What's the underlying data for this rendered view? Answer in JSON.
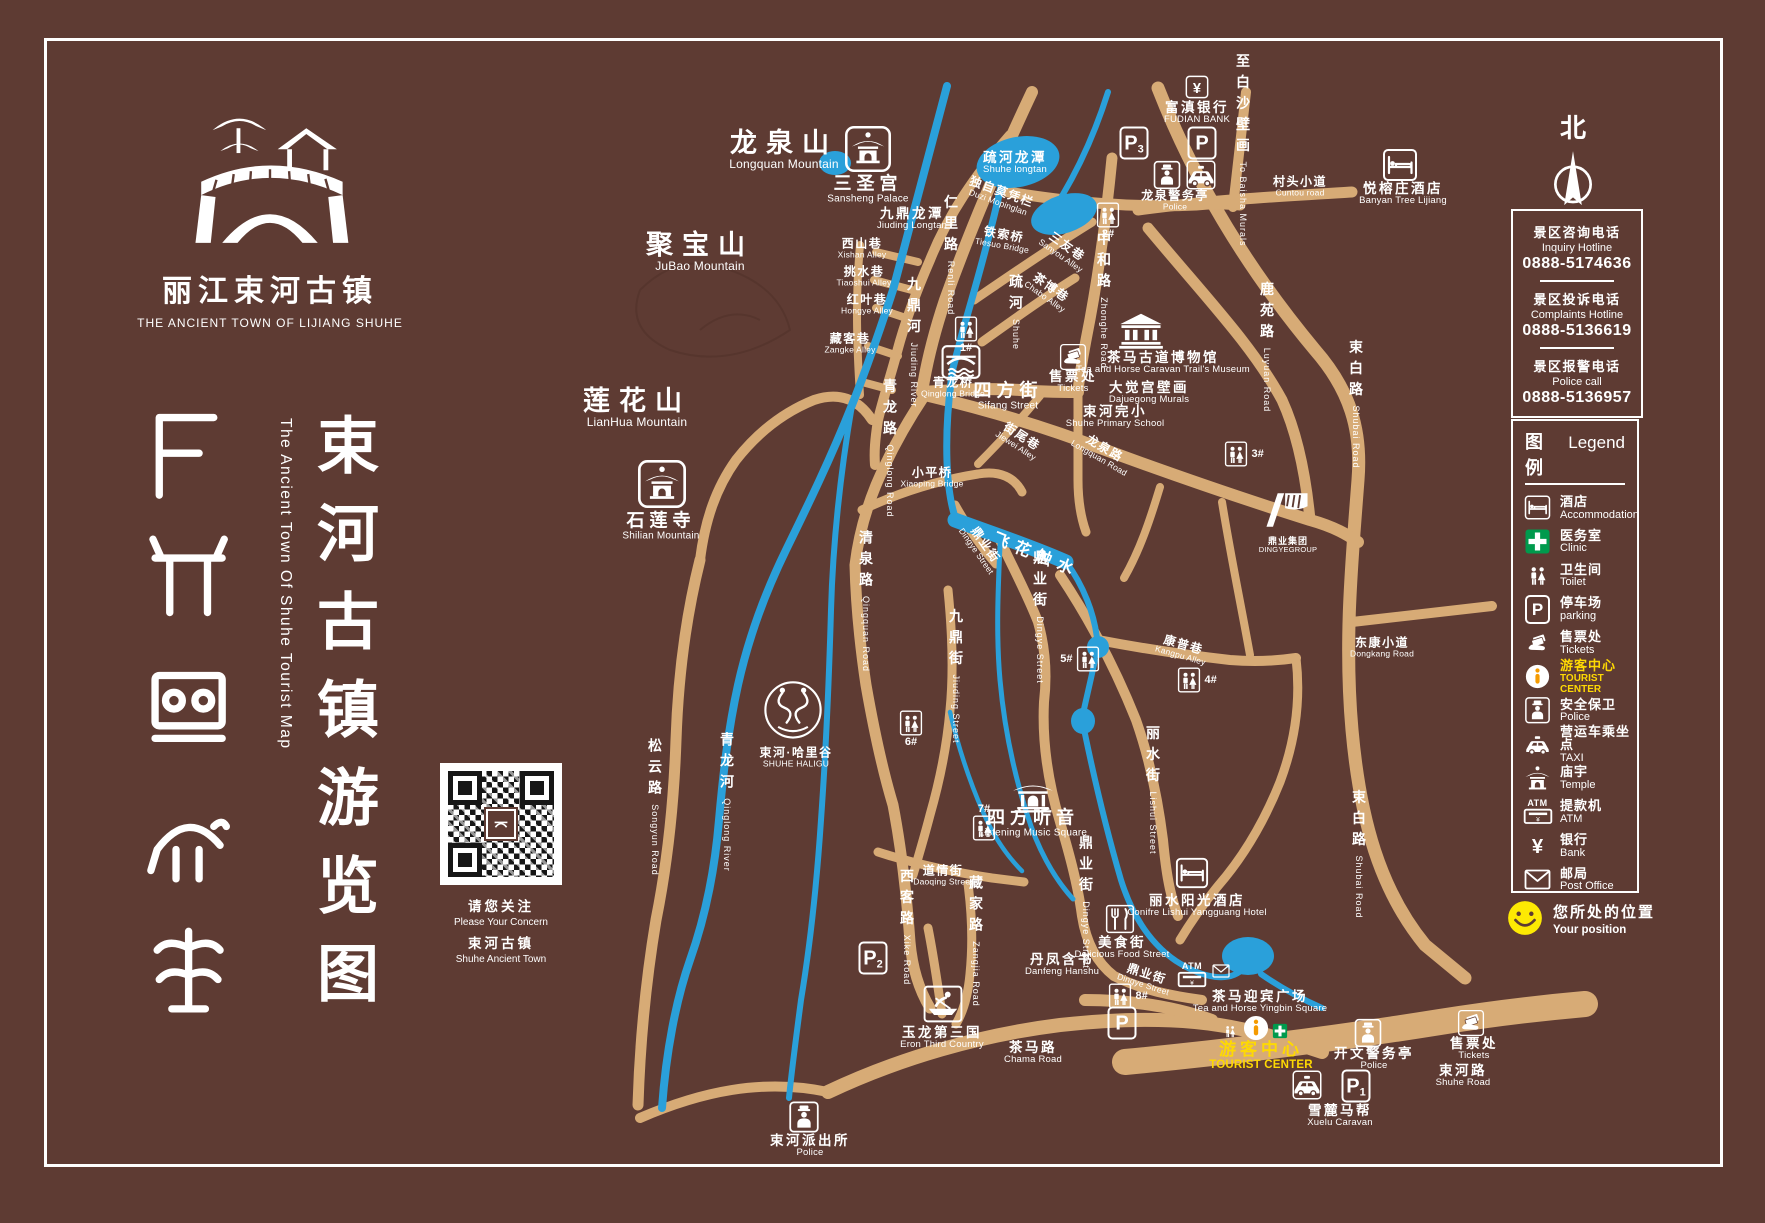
{
  "colors": {
    "background": "#5e3b33",
    "road": "#d7ab76",
    "water": "#2aa0da",
    "accent_yellow": "#fed903",
    "accent_orange": "#f59b00",
    "accent_green": "#009a4d"
  },
  "logo": {
    "zh": "丽江束河古镇",
    "en": "THE ANCIENT TOWN OF LIJIANG SHUHE"
  },
  "title": {
    "zh": "束河古镇游览图",
    "en": "The Ancient Town Of Shuhe Tourist Map"
  },
  "qr": {
    "l1": "请您关注",
    "l2": "Please Your Concern",
    "l3": "束河古镇",
    "l4": "Shuhe Ancient Town"
  },
  "north": {
    "label": "北"
  },
  "hotlines": [
    {
      "zh": "景区咨询电话",
      "en": "Inquiry Hotline",
      "num": "0888-5174636"
    },
    {
      "zh": "景区投诉电话",
      "en": "Complaints Hotline",
      "num": "0888-5136619"
    },
    {
      "zh": "景区报警电话",
      "en": "Police call",
      "num": "0888-5136957"
    }
  ],
  "legend": {
    "title_zh": "图例",
    "title_en": "Legend",
    "items": [
      {
        "icon": "bed",
        "zh": "酒店",
        "en": "Accommodation"
      },
      {
        "icon": "cross",
        "zh": "医务室",
        "en": "Clinic"
      },
      {
        "icon": "wc",
        "zh": "卫生间",
        "en": "Toilet"
      },
      {
        "icon": "p",
        "zh": "停车场",
        "en": "parking"
      },
      {
        "icon": "ticket",
        "zh": "售票处",
        "en": "Tickets"
      },
      {
        "icon": "info",
        "zh": "游客中心",
        "en": "TOURIST CENTER",
        "yellow": true
      },
      {
        "icon": "police",
        "zh": "安全保卫",
        "en": "Police"
      },
      {
        "icon": "taxi",
        "zh": "营运车乘坐点",
        "en": "TAXI"
      },
      {
        "icon": "temple",
        "zh": "庙宇",
        "en": "Temple"
      },
      {
        "icon": "atm",
        "zh": "提款机",
        "en": "ATM"
      },
      {
        "icon": "yen",
        "zh": "银行",
        "en": "Bank"
      },
      {
        "icon": "envelope",
        "zh": "邮局",
        "en": "Post Office"
      }
    ]
  },
  "position": {
    "zh": "您所处的位置",
    "en": "Your position"
  },
  "map": {
    "labels": [
      {
        "n": "label-longquan-mountain",
        "x": 784,
        "y": 150,
        "zh": "龙泉山",
        "en": "Longquan Mountain",
        "c": "mtn"
      },
      {
        "n": "label-jubao-mountain",
        "x": 700,
        "y": 252,
        "zh": "聚宝山",
        "en": "JuBao Mountain",
        "c": "mtn"
      },
      {
        "n": "label-lianhua-mountain",
        "x": 637,
        "y": 408,
        "zh": "莲花山",
        "en": "LianHua Mountain",
        "c": "mtn"
      },
      {
        "n": "label-sansheng-palace",
        "x": 868,
        "y": 189,
        "zh": "三圣宫",
        "en": "Sansheng Palace",
        "c": "plg"
      },
      {
        "n": "label-shilian-temple",
        "x": 661,
        "y": 526,
        "zh": "石莲寺",
        "en": "Shilian Mountain",
        "c": "plg"
      },
      {
        "n": "label-qinglong-bridge",
        "x": 953,
        "y": 388,
        "zh": "青龙桥",
        "en": "Qinglong Bridge",
        "c": "sm"
      },
      {
        "n": "label-sifang-street",
        "x": 1008,
        "y": 396,
        "zh": "四方街",
        "en": "Sifang Street",
        "c": "plg"
      },
      {
        "n": "label-tea-horse-museum",
        "x": 1163,
        "y": 363,
        "zh": "茶马古道博物馆",
        "en": "Tea and Horse Caravan Trail's Museum",
        "c": ""
      },
      {
        "n": "label-dajuegong-murals",
        "x": 1149,
        "y": 393,
        "zh": "大觉宫壁画",
        "en": "Dajuegong Murals",
        "c": ""
      },
      {
        "n": "label-shuhe-primary-school",
        "x": 1115,
        "y": 417,
        "zh": "束河完小",
        "en": "Shuhe Primary School",
        "c": ""
      },
      {
        "n": "label-shuhe-longtan",
        "x": 1015,
        "y": 163,
        "zh": "疏河龙潭",
        "en": "Shuhe longtan",
        "c": ""
      },
      {
        "n": "label-jiuding-longtan",
        "x": 912,
        "y": 219,
        "zh": "九鼎龙潭",
        "en": "Jiuding Longtan",
        "c": ""
      },
      {
        "n": "label-duzi-mopinglan",
        "x": 1000,
        "y": 197,
        "zh": "独自莫凭栏",
        "en": "Duzi Mopinglan",
        "c": "sm",
        "r": 20
      },
      {
        "n": "label-tiesuo-bridge",
        "x": 1003,
        "y": 240,
        "zh": "铁索桥",
        "en": "Tiesuo Bridge",
        "c": "sm",
        "r": 10
      },
      {
        "n": "label-xiaoping-bridge",
        "x": 932,
        "y": 478,
        "zh": "小平桥",
        "en": "Xiaoping Bridge",
        "c": "sm"
      },
      {
        "n": "label-listening-music-square",
        "x": 1033,
        "y": 823,
        "zh": "四方听音",
        "en": "Listening Music Square",
        "c": "plg"
      },
      {
        "n": "label-eron-third-country",
        "x": 942,
        "y": 1038,
        "zh": "玉龙第三国",
        "en": "Eron Third Country",
        "c": ""
      },
      {
        "n": "label-tea-horse-square",
        "x": 1260,
        "y": 1002,
        "zh": "茶马迎宾广场",
        "en": "Tea and Horse Yingbin Square",
        "c": ""
      },
      {
        "n": "label-xuelu-caravan",
        "x": 1340,
        "y": 1116,
        "zh": "雪麓马帮",
        "en": "Xuelu Caravan",
        "c": ""
      },
      {
        "n": "label-danfeng-hanshu",
        "x": 1062,
        "y": 965,
        "zh": "丹凤含书",
        "en": "Danfeng Hanshu",
        "c": ""
      },
      {
        "n": "label-delicious-food-street",
        "x": 1122,
        "y": 948,
        "zh": "美食街",
        "en": "Delicious Food Street",
        "c": ""
      },
      {
        "n": "label-lishui-hotel",
        "x": 1197,
        "y": 906,
        "zh": "丽水阳光酒店",
        "en": "Conifre Lishui Yangguang Hotel",
        "c": ""
      },
      {
        "n": "label-banyan-tree",
        "x": 1403,
        "y": 194,
        "zh": "悦榕庄酒店",
        "en": "Banyan Tree Lijiang",
        "c": ""
      },
      {
        "n": "label-fudian-bank",
        "x": 1197,
        "y": 113,
        "zh": "富滇银行",
        "en": "FUDIAN BANK",
        "c": ""
      },
      {
        "n": "label-tickets-sifang",
        "x": 1073,
        "y": 382,
        "zh": "售票处",
        "en": "Tickets",
        "c": ""
      },
      {
        "n": "label-tickets-shuhe-road",
        "x": 1474,
        "y": 1049,
        "zh": "售票处",
        "en": "Tickets",
        "c": ""
      },
      {
        "n": "label-longquan-police",
        "x": 1175,
        "y": 201,
        "zh": "龙泉警务亭",
        "en": "Police",
        "c": "sm"
      },
      {
        "n": "label-kaiwen-police",
        "x": 1374,
        "y": 1059,
        "zh": "开文警务亭",
        "en": "Police",
        "c": ""
      },
      {
        "n": "label-shuhe-police-station",
        "x": 810,
        "y": 1146,
        "zh": "束河派出所",
        "en": "Police",
        "c": ""
      },
      {
        "n": "label-tourist-center",
        "x": 1261,
        "y": 1056,
        "zh": "游客中心",
        "en": "TOURIST CENTER",
        "c": "yellow"
      },
      {
        "n": "label-shuhe-haligu",
        "x": 796,
        "y": 758,
        "zh": "束河·哈里谷",
        "en": "SHUHE HALIGU",
        "c": "sm"
      },
      {
        "n": "label-dingye-group",
        "x": 1288,
        "y": 545,
        "zh": "鼎业集团",
        "en": "DINGYEGROUP",
        "c": "tiny"
      },
      {
        "n": "label-xishan-alley",
        "x": 862,
        "y": 249,
        "zh": "西山巷",
        "en": "Xishan Alley",
        "c": "sm"
      },
      {
        "n": "label-tiaoshui-alley",
        "x": 864,
        "y": 277,
        "zh": "挑水巷",
        "en": "Tiaoshui Alley",
        "c": "sm"
      },
      {
        "n": "label-hongye-alley",
        "x": 867,
        "y": 305,
        "zh": "红叶巷",
        "en": "Hongye Alley",
        "c": "sm"
      },
      {
        "n": "label-zangke-alley",
        "x": 850,
        "y": 344,
        "zh": "藏客巷",
        "en": "Zangke Alley",
        "c": "sm"
      },
      {
        "n": "label-sanyou-alley",
        "x": 1064,
        "y": 251,
        "zh": "三友巷",
        "en": "Sanyou Alley",
        "c": "sm",
        "r": 35
      },
      {
        "n": "label-chabo-alley",
        "x": 1048,
        "y": 292,
        "zh": "茶博巷",
        "en": "Chabo Alley",
        "c": "sm",
        "r": 35
      },
      {
        "n": "label-jiewei-alley",
        "x": 1019,
        "y": 441,
        "zh": "街尾巷",
        "en": "Jiewei Alley",
        "c": "sm",
        "r": 33
      },
      {
        "n": "label-kangpu-alley",
        "x": 1182,
        "y": 650,
        "zh": "康普巷",
        "en": "Kangpu Alley",
        "c": "sm",
        "r": 16
      },
      {
        "n": "label-renli-road",
        "x": 951,
        "y": 255,
        "zh": "仁里路",
        "en": "Renli Road",
        "c": "v"
      },
      {
        "n": "label-zhonghe-road",
        "x": 1104,
        "y": 300,
        "zh": "中和路",
        "en": "Zhonghe Road",
        "c": "v"
      },
      {
        "n": "label-luyuan-road",
        "x": 1267,
        "y": 347,
        "zh": "鹿苑路",
        "en": "Luyuan Road",
        "c": "v"
      },
      {
        "n": "label-shubai-road-north",
        "x": 1356,
        "y": 404,
        "zh": "束白路",
        "en": "Shubai Road",
        "c": "v"
      },
      {
        "n": "label-shubai-road-south",
        "x": 1359,
        "y": 854,
        "zh": "束白路",
        "en": "Shubai Road",
        "c": "v"
      },
      {
        "n": "label-to-baisha-murals",
        "x": 1243,
        "y": 150,
        "zh": "至白沙壁画",
        "en": "To Baisha Murals",
        "c": "v"
      },
      {
        "n": "label-qingquan-road",
        "x": 866,
        "y": 601,
        "zh": "清泉路",
        "en": "Qingquan Road",
        "c": "v"
      },
      {
        "n": "label-qinglong-road",
        "x": 890,
        "y": 448,
        "zh": "青龙路",
        "en": "Qinglong Road",
        "c": "v"
      },
      {
        "n": "label-jiuding-street",
        "x": 956,
        "y": 676,
        "zh": "九鼎街",
        "en": "Jiuding Street",
        "c": "v"
      },
      {
        "n": "label-dingye-street-nw",
        "x": 981,
        "y": 548,
        "zh": "鼎业街",
        "en": "Dingye Street",
        "c": "sm",
        "r": 55
      },
      {
        "n": "label-dingye-street-mid",
        "x": 1040,
        "y": 617,
        "zh": "鼎业街",
        "en": "Dingye Street",
        "c": "v"
      },
      {
        "n": "label-dingye-street-south",
        "x": 1086,
        "y": 902,
        "zh": "鼎业街",
        "en": "Dingye Street",
        "c": "v"
      },
      {
        "n": "label-dingye-street-bottom",
        "x": 1145,
        "y": 979,
        "zh": "鼎业街",
        "en": "Dingye Street",
        "c": "sm",
        "r": 18
      },
      {
        "n": "label-lishui-street",
        "x": 1153,
        "y": 790,
        "zh": "丽水街",
        "en": "Lishui Street",
        "c": "v"
      },
      {
        "n": "label-xike-road",
        "x": 907,
        "y": 927,
        "zh": "西客路",
        "en": "Xike Road",
        "c": "v"
      },
      {
        "n": "label-zangjia-road",
        "x": 976,
        "y": 941,
        "zh": "藏家路",
        "en": "Zangjia Road",
        "c": "v"
      },
      {
        "n": "label-songyun-road",
        "x": 655,
        "y": 807,
        "zh": "松云路",
        "en": "Songyun Road",
        "c": "v"
      },
      {
        "n": "label-qinglong-river",
        "x": 727,
        "y": 802,
        "zh": "青龙河",
        "en": "Qinglong River",
        "c": "v"
      },
      {
        "n": "label-jiuding-river",
        "x": 914,
        "y": 342,
        "zh": "九鼎河",
        "en": "Jiuding River",
        "c": "v"
      },
      {
        "n": "label-shuhe-river",
        "x": 1016,
        "y": 312,
        "zh": "疏河",
        "en": "Shuhe",
        "c": "v"
      },
      {
        "n": "label-feihua-water",
        "x": 1036,
        "y": 556,
        "zh": "飞花触水",
        "en": "",
        "c": "wtr",
        "r": 22
      },
      {
        "n": "label-cuntou-road",
        "x": 1300,
        "y": 187,
        "zh": "村头小道",
        "en": "Cuntou road",
        "c": "sm"
      },
      {
        "n": "label-dongkang-road",
        "x": 1382,
        "y": 648,
        "zh": "东康小道",
        "en": "Dongkang Road",
        "c": "sm"
      },
      {
        "n": "label-longquan-road",
        "x": 1102,
        "y": 453,
        "zh": "龙泉路",
        "en": "Longquan Road",
        "c": "sm",
        "r": 30
      },
      {
        "n": "label-daoqing-street",
        "x": 943,
        "y": 876,
        "zh": "道情街",
        "en": "Daoqing Street",
        "c": "sm"
      },
      {
        "n": "label-chama-road",
        "x": 1033,
        "y": 1053,
        "zh": "茶马路",
        "en": "Chama Road",
        "c": ""
      },
      {
        "n": "label-shuhe-road",
        "x": 1463,
        "y": 1076,
        "zh": "束河路",
        "en": "Shuhe Road",
        "c": ""
      }
    ],
    "icons": [
      {
        "n": "sansheng-palace-icon",
        "t": "templeB",
        "x": 868,
        "y": 149,
        "s": 46
      },
      {
        "n": "shilian-temple-icon",
        "t": "templeB",
        "x": 662,
        "y": 484,
        "s": 48
      },
      {
        "n": "qinglong-bridge-icon",
        "t": "bridge",
        "x": 961,
        "y": 362,
        "s": 40
      },
      {
        "n": "tea-horse-museum-icon",
        "t": "museum",
        "x": 1141,
        "y": 331,
        "s": 46
      },
      {
        "n": "listening-music-square-icon",
        "t": "gate",
        "x": 1033,
        "y": 796,
        "s": 42
      },
      {
        "n": "eron-third-country-icon",
        "t": "boat",
        "x": 943,
        "y": 1004,
        "s": 40
      },
      {
        "n": "longquan-police-icon",
        "t": "police",
        "x": 1167,
        "y": 175,
        "s": 29
      },
      {
        "n": "longquan-taxi-icon",
        "t": "taxiB",
        "x": 1201,
        "y": 175,
        "s": 30
      },
      {
        "n": "kaiwen-police-icon",
        "t": "police",
        "x": 1368,
        "y": 1033,
        "s": 29
      },
      {
        "n": "shuhe-police-station-icon",
        "t": "police",
        "x": 804,
        "y": 1117,
        "s": 32
      },
      {
        "n": "banyan-tree-hotel-icon",
        "t": "bed",
        "x": 1400,
        "y": 165,
        "s": 36
      },
      {
        "n": "lishui-hotel-icon",
        "t": "bed",
        "x": 1192,
        "y": 873,
        "s": 34
      },
      {
        "n": "fudian-bank-icon",
        "t": "yenB",
        "x": 1197,
        "y": 87,
        "s": 24
      },
      {
        "n": "parking-p3-icon",
        "t": "p",
        "x": 1134,
        "y": 143,
        "sub": "3"
      },
      {
        "n": "parking-north-icon",
        "t": "p",
        "x": 1202,
        "y": 143,
        "sub": ""
      },
      {
        "n": "parking-p2-icon",
        "t": "p",
        "x": 873,
        "y": 958,
        "sub": "2"
      },
      {
        "n": "parking-p1-icon",
        "t": "p",
        "x": 1356,
        "y": 1086,
        "sub": "1"
      },
      {
        "n": "parking-south-icon",
        "t": "p",
        "x": 1122,
        "y": 1023,
        "sub": ""
      },
      {
        "n": "xuelu-taxi-icon",
        "t": "taxiB",
        "x": 1307,
        "y": 1085,
        "s": 30
      },
      {
        "n": "tickets-sifang-icon",
        "t": "ticketB",
        "x": 1073,
        "y": 357,
        "s": 27
      },
      {
        "n": "tickets-shuhe-road-icon",
        "t": "ticketB",
        "x": 1471,
        "y": 1023,
        "s": 27
      },
      {
        "n": "atm-icon",
        "t": "atm",
        "x": 1192,
        "y": 975
      },
      {
        "n": "post-office-icon",
        "t": "envelope",
        "x": 1221,
        "y": 971,
        "s": 18
      },
      {
        "n": "tourist-center-toilet-icon",
        "t": "wc",
        "x": 1230,
        "y": 1031,
        "s": 17
      },
      {
        "n": "tourist-center-info-icon",
        "t": "info",
        "x": 1256,
        "y": 1028,
        "s": 28
      },
      {
        "n": "tourist-center-clinic-icon",
        "t": "cross",
        "x": 1280,
        "y": 1031,
        "s": 16
      },
      {
        "n": "toilet-1-icon",
        "t": "toilet",
        "x": 966,
        "y": 329,
        "num": "1#",
        "np": "b"
      },
      {
        "n": "toilet-2-icon",
        "t": "toilet",
        "x": 1108,
        "y": 215,
        "num": "2#",
        "np": "b"
      },
      {
        "n": "toilet-3-icon",
        "t": "toilet",
        "x": 1236,
        "y": 454,
        "num": "3#",
        "np": "r"
      },
      {
        "n": "toilet-4-icon",
        "t": "toilet",
        "x": 1189,
        "y": 680,
        "num": "4#",
        "np": "r"
      },
      {
        "n": "toilet-5-icon",
        "t": "toilet",
        "x": 1088,
        "y": 659,
        "num": "5#",
        "np": "l"
      },
      {
        "n": "toilet-6-icon",
        "t": "toilet",
        "x": 911,
        "y": 723,
        "num": "6#",
        "np": "b"
      },
      {
        "n": "toilet-7-icon",
        "t": "toilet",
        "x": 984,
        "y": 828,
        "num": "7#",
        "np": "t"
      },
      {
        "n": "toilet-8-icon",
        "t": "toilet",
        "x": 1120,
        "y": 996,
        "num": "8#",
        "np": "r"
      },
      {
        "n": "food-street-icon",
        "t": "fork",
        "x": 1120,
        "y": 919,
        "s": 30
      },
      {
        "n": "shuhe-haligu-logo",
        "t": "haligu",
        "x": 793,
        "y": 712,
        "s": 68
      },
      {
        "n": "dingye-group-logo",
        "t": "dingye",
        "x": 1287,
        "y": 510,
        "s": 56
      }
    ]
  }
}
